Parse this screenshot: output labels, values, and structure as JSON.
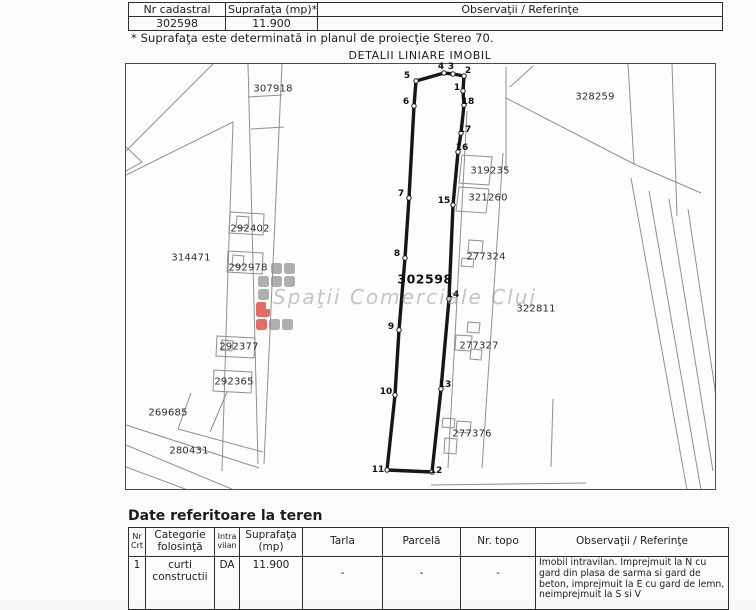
{
  "document": {
    "top_table": {
      "headers": [
        "Nr cadastral",
        "Suprafaţa (mp)*",
        "Observaţii / Referinţe"
      ],
      "row": {
        "nr_cadastral": "302598",
        "suprafata": "11.900",
        "observatii": ""
      },
      "note": "* Suprafaţa este determinată in planul de proiecţie Stereo 70."
    },
    "map": {
      "title": "DETALII LINIARE IMOBIL",
      "subject_parcel": {
        "number": "302598",
        "label_pos": {
          "x": 424,
          "y": 278
        },
        "vertices": [
          {
            "n": "5",
            "x": 415,
            "y": 80,
            "lx": 406,
            "ly": 75
          },
          {
            "n": "4",
            "x": 443,
            "y": 72,
            "lx": 440,
            "ly": 66
          },
          {
            "n": "3",
            "x": 452,
            "y": 73,
            "lx": 450,
            "ly": 66
          },
          {
            "n": "2",
            "x": 463,
            "y": 75,
            "lx": 467,
            "ly": 70
          },
          {
            "n": "1",
            "x": 462,
            "y": 90,
            "lx": 456,
            "ly": 87
          },
          {
            "n": "18",
            "x": 463,
            "y": 104,
            "lx": 467,
            "ly": 101
          },
          {
            "n": "17",
            "x": 460,
            "y": 132,
            "lx": 464,
            "ly": 129
          },
          {
            "n": "16",
            "x": 457,
            "y": 151,
            "lx": 461,
            "ly": 147
          },
          {
            "n": "15",
            "x": 452,
            "y": 204,
            "lx": 443,
            "ly": 200
          },
          {
            "n": "14",
            "x": 448,
            "y": 298,
            "lx": 452,
            "ly": 294
          },
          {
            "n": "13",
            "x": 440,
            "y": 388,
            "lx": 444,
            "ly": 384
          },
          {
            "n": "12",
            "x": 431,
            "y": 471,
            "lx": 435,
            "ly": 470
          },
          {
            "n": "11",
            "x": 386,
            "y": 469,
            "lx": 377,
            "ly": 469
          },
          {
            "n": "10",
            "x": 394,
            "y": 394,
            "lx": 385,
            "ly": 391
          },
          {
            "n": "9",
            "x": 398,
            "y": 329,
            "lx": 390,
            "ly": 326
          },
          {
            "n": "8",
            "x": 404,
            "y": 257,
            "lx": 396,
            "ly": 253
          },
          {
            "n": "7",
            "x": 408,
            "y": 197,
            "lx": 400,
            "ly": 193
          },
          {
            "n": "6",
            "x": 413,
            "y": 105,
            "lx": 405,
            "ly": 101
          }
        ]
      },
      "neighbor_labels": [
        {
          "text": "307918",
          "x": 272,
          "y": 88
        },
        {
          "text": "328259",
          "x": 594,
          "y": 96
        },
        {
          "text": "314471",
          "x": 190,
          "y": 257
        },
        {
          "text": "292402",
          "x": 249,
          "y": 228
        },
        {
          "text": "292978",
          "x": 247,
          "y": 267
        },
        {
          "text": "292377",
          "x": 238,
          "y": 346
        },
        {
          "text": "292365",
          "x": 233,
          "y": 381
        },
        {
          "text": "269685",
          "x": 167,
          "y": 412
        },
        {
          "text": "280431",
          "x": 188,
          "y": 450
        },
        {
          "text": "319235",
          "x": 489,
          "y": 170
        },
        {
          "text": "321260",
          "x": 487,
          "y": 197
        },
        {
          "text": "277324",
          "x": 485,
          "y": 256
        },
        {
          "text": "277327",
          "x": 478,
          "y": 345
        },
        {
          "text": "277376",
          "x": 471,
          "y": 433
        },
        {
          "text": "322811",
          "x": 535,
          "y": 308
        }
      ],
      "watermark": {
        "text": "Spaţii Comerciale Cluj"
      }
    },
    "land_section": {
      "heading": "Date referitoare la teren",
      "headers": [
        "Nr Crt",
        "Categorie folosinţă",
        "Intra vilan",
        "Suprafaţa (mp)",
        "Tarla",
        "Parcelă",
        "Nr. topo",
        "Observaţii / Referinţe"
      ],
      "row": {
        "nr": "1",
        "categorie": "curti constructii",
        "intravilan": "DA",
        "suprafata": "11.900",
        "tarla": "-",
        "parcela": "-",
        "nr_topo": "-",
        "observatii": "Imobil intravilan. Imprejmuit la N cu gard din plasa de sarma si gard de beton, imprejmuit la E cu gard de lemn, neimprejmuit la S si V"
      }
    }
  }
}
